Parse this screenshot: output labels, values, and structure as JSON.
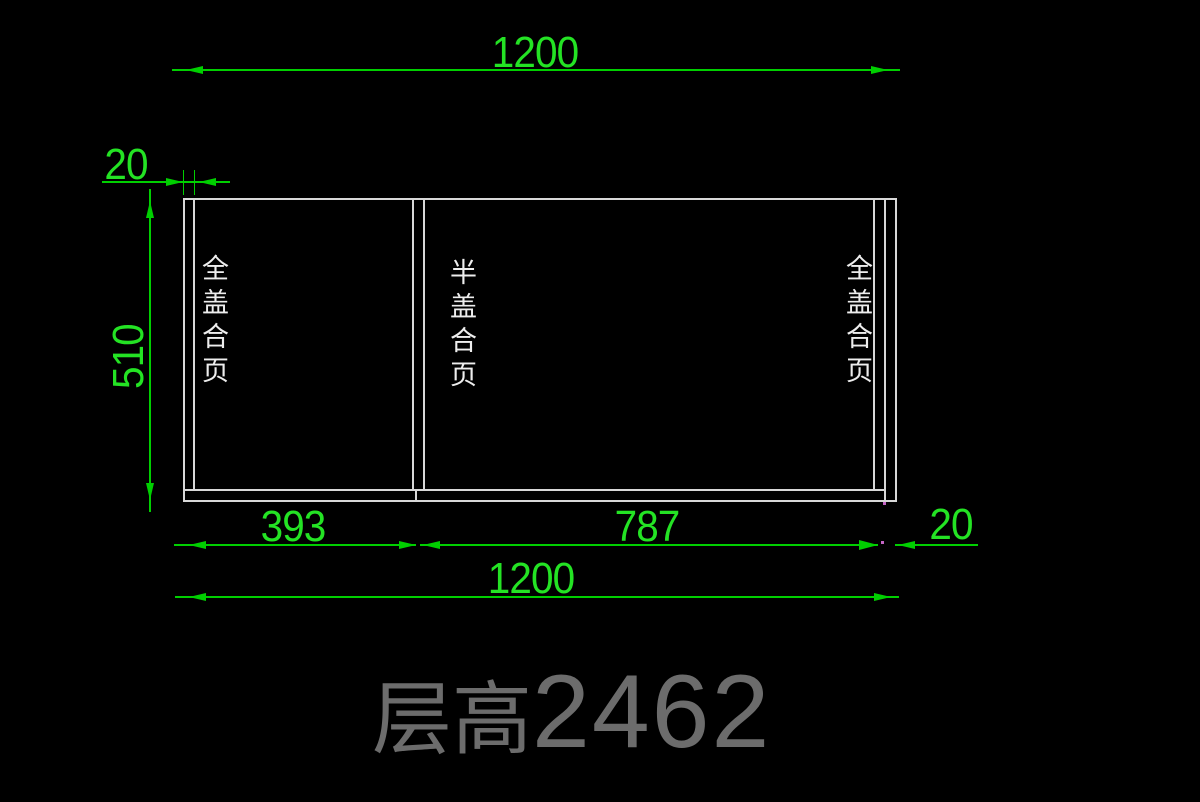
{
  "drawing": {
    "type": "cabinet-elevation-cad-view",
    "background_color": "#000000",
    "colors": {
      "dimension_lines": "#00cf00",
      "dimension_text": "#24e324",
      "cabinet_outline": "#d8d8d8",
      "hinge_label_text": "#ededed",
      "floor_title_text": "#6c6c6c",
      "snap_marker": "#c565c5"
    }
  },
  "dims": {
    "top_overall_width": "1200",
    "left_panel_thickness": "20",
    "cabinet_height": "510",
    "left_section_width": "393",
    "right_section_width": "787",
    "right_panel_thickness": "20",
    "bottom_overall_width": "1200"
  },
  "labels": {
    "left_door": "全盖合页",
    "middle_door": "半盖合页",
    "right_door": "全盖合页"
  },
  "title": {
    "prefix": "层高",
    "value": "2462"
  }
}
